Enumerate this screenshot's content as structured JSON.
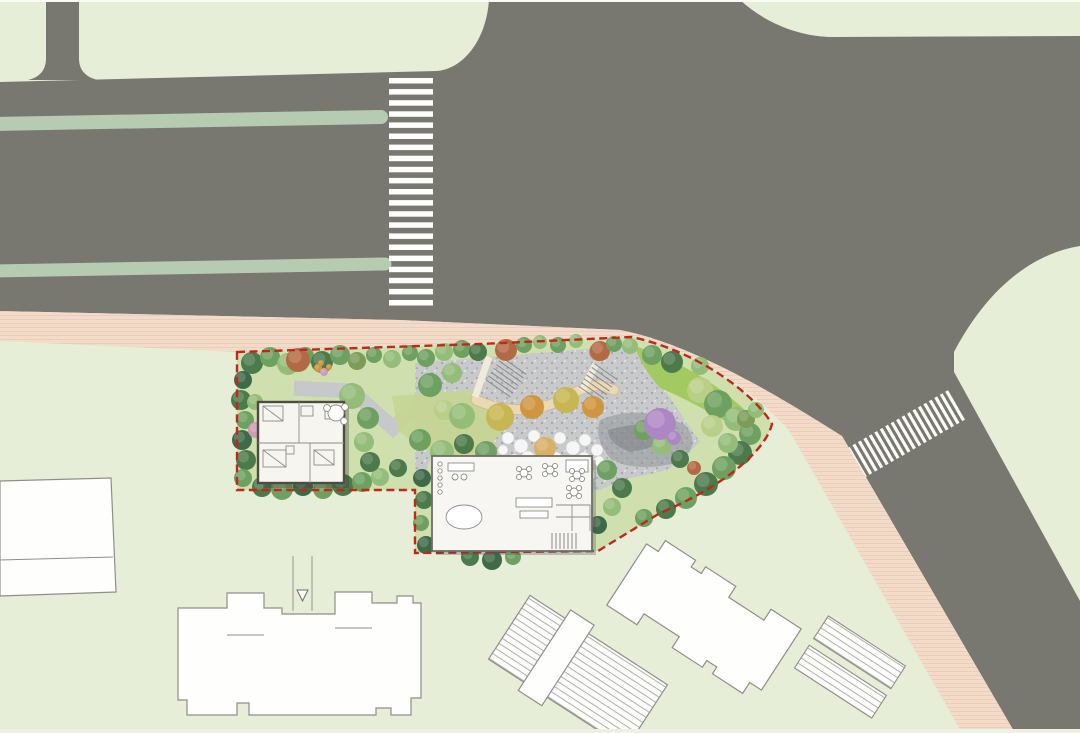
{
  "scene": {
    "kind": "landscape-architecture site plan, top view",
    "canvas": {
      "w": 1080,
      "h": 733
    }
  },
  "palette": {
    "lawn": "#e6eed8",
    "road": "#787770",
    "median": "#b6ccb1",
    "sidewalk": "#f3dbc9",
    "sidewalk_line": "#e8cbb5",
    "plaza": "#c7c9cb",
    "plaza_dot": "#8f9195",
    "site_green": "#cfe0ae",
    "bright_lawn": "#a3ca60",
    "mid_lawn": "#c6d693",
    "boundary_red": "#c2271b",
    "crosswalk_white": "#fdfdfb",
    "hatch": "#a8a8a2",
    "shadow": "#8e9196",
    "canopy_cream": "#ead9b2",
    "building_fill": "#f6f5f0"
  },
  "tree_palette": [
    "#4c7a4b",
    "#6ea161",
    "#93bd79",
    "#b9cf87",
    "#7d9c58",
    "#d0953f",
    "#d8b066",
    "#b26a45",
    "#3f6a49",
    "#cf9bb4",
    "#ad87c3",
    "#c8b652"
  ],
  "trees": [
    [
      252,
      363,
      11,
      0
    ],
    [
      270,
      357,
      10,
      1
    ],
    [
      288,
      364,
      11,
      2
    ],
    [
      305,
      356,
      9,
      1
    ],
    [
      298,
      360,
      12,
      7
    ],
    [
      322,
      362,
      11,
      0
    ],
    [
      340,
      355,
      10,
      1
    ],
    [
      357,
      361,
      9,
      4
    ],
    [
      374,
      355,
      8,
      1
    ],
    [
      392,
      359,
      9,
      2
    ],
    [
      410,
      353,
      8,
      1
    ],
    [
      426,
      358,
      9,
      1
    ],
    [
      444,
      352,
      9,
      2
    ],
    [
      462,
      349,
      9,
      1
    ],
    [
      478,
      352,
      9,
      0
    ],
    [
      318,
      368,
      4,
      5
    ],
    [
      324,
      372,
      4,
      9
    ],
    [
      329,
      367,
      3,
      5
    ],
    [
      321,
      363,
      3,
      5
    ],
    [
      506,
      350,
      11,
      7
    ],
    [
      600,
      351,
      10,
      7
    ],
    [
      524,
      345,
      8,
      1
    ],
    [
      540,
      342,
      7,
      2
    ],
    [
      558,
      345,
      8,
      1
    ],
    [
      576,
      341,
      7,
      2
    ],
    [
      614,
      344,
      8,
      1
    ],
    [
      630,
      346,
      8,
      2
    ],
    [
      243,
      380,
      9,
      8
    ],
    [
      241,
      400,
      10,
      0
    ],
    [
      245,
      420,
      9,
      1
    ],
    [
      242,
      440,
      10,
      8
    ],
    [
      246,
      460,
      10,
      0
    ],
    [
      243,
      478,
      9,
      1
    ],
    [
      256,
      430,
      8,
      9
    ],
    [
      262,
      487,
      10,
      0
    ],
    [
      282,
      489,
      11,
      1
    ],
    [
      303,
      486,
      10,
      8
    ],
    [
      323,
      489,
      10,
      1
    ],
    [
      343,
      485,
      11,
      0
    ],
    [
      362,
      482,
      10,
      1
    ],
    [
      380,
      477,
      9,
      2
    ],
    [
      398,
      468,
      9,
      0
    ],
    [
      352,
      396,
      13,
      2
    ],
    [
      368,
      418,
      11,
      1
    ],
    [
      364,
      442,
      10,
      2
    ],
    [
      370,
      462,
      10,
      0
    ],
    [
      255,
      402,
      8,
      2
    ],
    [
      430,
      385,
      12,
      1
    ],
    [
      452,
      373,
      10,
      2
    ],
    [
      444,
      410,
      10,
      3
    ],
    [
      420,
      440,
      11,
      1
    ],
    [
      442,
      452,
      12,
      2
    ],
    [
      464,
      444,
      10,
      0
    ],
    [
      486,
      452,
      11,
      1
    ],
    [
      462,
      416,
      13,
      2
    ],
    [
      478,
      470,
      10,
      8
    ],
    [
      497,
      477,
      9,
      9
    ],
    [
      514,
      468,
      9,
      1
    ],
    [
      500,
      417,
      14,
      11
    ],
    [
      532,
      407,
      12,
      5
    ],
    [
      566,
      400,
      13,
      11
    ],
    [
      593,
      407,
      11,
      5
    ],
    [
      545,
      448,
      11,
      6
    ],
    [
      652,
      355,
      10,
      1
    ],
    [
      672,
      362,
      11,
      0
    ],
    [
      700,
      390,
      13,
      3
    ],
    [
      718,
      404,
      14,
      1
    ],
    [
      736,
      419,
      12,
      2
    ],
    [
      750,
      434,
      11,
      1
    ],
    [
      740,
      453,
      12,
      0
    ],
    [
      724,
      468,
      12,
      1
    ],
    [
      706,
      484,
      12,
      0
    ],
    [
      686,
      498,
      11,
      1
    ],
    [
      666,
      509,
      10,
      0
    ],
    [
      644,
      518,
      9,
      1
    ],
    [
      712,
      426,
      11,
      3
    ],
    [
      728,
      443,
      10,
      2
    ],
    [
      746,
      419,
      9,
      4
    ],
    [
      644,
      430,
      10,
      1
    ],
    [
      662,
      445,
      10,
      2
    ],
    [
      680,
      459,
      9,
      0
    ],
    [
      607,
      470,
      10,
      1
    ],
    [
      622,
      488,
      10,
      0
    ],
    [
      612,
      507,
      9,
      2
    ],
    [
      598,
      525,
      9,
      8
    ],
    [
      660,
      424,
      16,
      10
    ],
    [
      674,
      438,
      7,
      10
    ],
    [
      694,
      468,
      7,
      7
    ],
    [
      422,
      478,
      9,
      8
    ],
    [
      424,
      500,
      9,
      0
    ],
    [
      421,
      523,
      8,
      1
    ],
    [
      426,
      545,
      9,
      8
    ],
    [
      470,
      557,
      9,
      0
    ],
    [
      492,
      560,
      10,
      8
    ],
    [
      513,
      557,
      8,
      1
    ],
    [
      756,
      410,
      8,
      2
    ],
    [
      700,
      366,
      9,
      2
    ]
  ],
  "plaza_circles": [
    [
      508,
      438,
      6
    ],
    [
      521,
      446,
      7
    ],
    [
      534,
      436,
      6
    ],
    [
      547,
      448,
      7
    ],
    [
      560,
      438,
      6
    ],
    [
      573,
      448,
      7
    ],
    [
      585,
      440,
      6
    ],
    [
      597,
      450,
      6
    ],
    [
      514,
      460,
      6
    ],
    [
      528,
      458,
      7
    ],
    [
      542,
      462,
      7
    ],
    [
      556,
      458,
      6
    ],
    [
      570,
      462,
      7
    ],
    [
      584,
      458,
      6
    ],
    [
      522,
      472,
      6
    ],
    [
      536,
      474,
      6
    ],
    [
      550,
      472,
      7
    ],
    [
      564,
      474,
      6
    ],
    [
      578,
      470,
      6
    ],
    [
      530,
      484,
      5
    ],
    [
      546,
      486,
      6
    ],
    [
      561,
      484,
      5
    ],
    [
      599,
      461,
      5
    ],
    [
      503,
      450,
      5
    ],
    [
      590,
      475,
      5
    ],
    [
      512,
      480,
      5
    ]
  ],
  "crosswalks": {
    "north": {
      "x": 389,
      "y": 78,
      "w": 44,
      "count": 21,
      "stripe_h": 5.5,
      "gap": 5.6
    },
    "east": {
      "cx": 906,
      "cy": 434,
      "angle": 60,
      "bar_len": 34,
      "bar_th": 3.2,
      "count": 19,
      "gap": 6.3
    }
  },
  "medians": [
    {
      "x1": -8,
      "y1": 124,
      "x2": 381,
      "y2": 117,
      "w": 14
    },
    {
      "x1": -8,
      "y1": 271,
      "x2": 385,
      "y2": 264,
      "w": 13
    }
  ],
  "stairs": [
    {
      "x": 506,
      "y": 377,
      "angle": 35,
      "count": 7,
      "len": 30,
      "gap": 4.6
    },
    {
      "x": 598,
      "y": 383,
      "angle": 35,
      "count": 7,
      "len": 28,
      "gap": 4.6
    }
  ],
  "boundary": {
    "dash": "8 4.5",
    "width": 2.4
  }
}
